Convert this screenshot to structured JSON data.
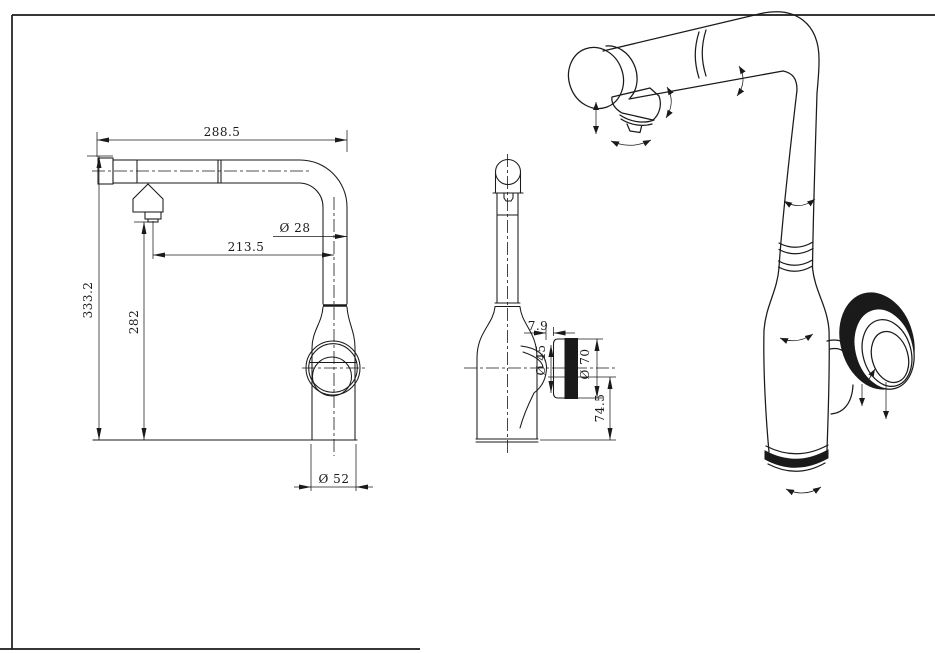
{
  "colors": {
    "background": "#ffffff",
    "ink": "#1a1a1a"
  },
  "front_view": {
    "dims": {
      "overall_width": "288.5",
      "spout_reach": "213.5",
      "pipe_diameter": "Ø 28",
      "overall_height": "333.2",
      "outlet_height": "282",
      "base_diameter": "Ø 52"
    }
  },
  "side_view": {
    "dims": {
      "knob_gap": "7.9",
      "boss_diameter": "Ø 45",
      "knob_diameter": "Ø 70",
      "outlet_to_base": "74.5"
    }
  }
}
